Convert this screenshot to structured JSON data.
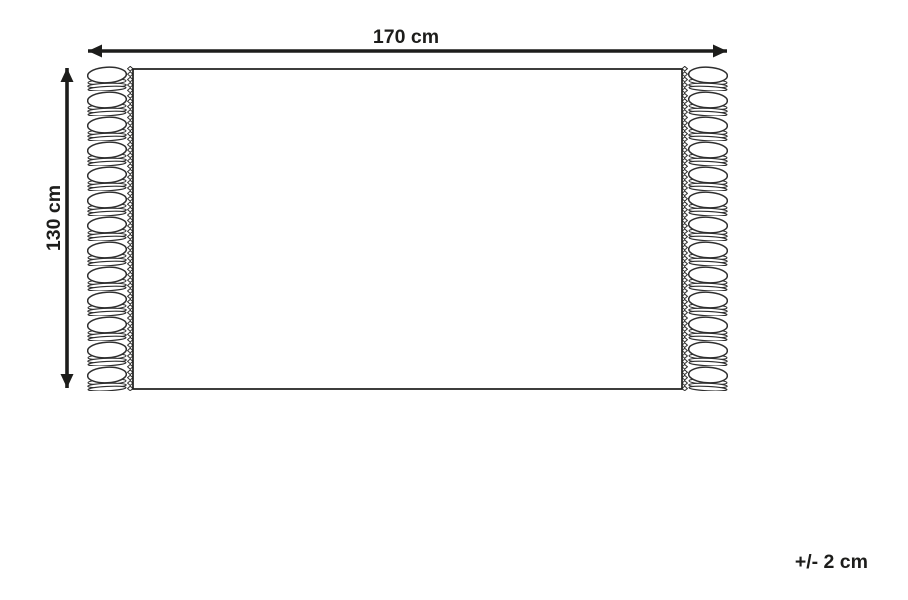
{
  "diagram": {
    "width_label": "170 cm",
    "height_label": "130 cm",
    "tolerance_label": "+/- 2 cm",
    "line_color": "#1d1d1b",
    "fringe_line_color": "#2e2e2e",
    "background_color": "#ffffff"
  }
}
